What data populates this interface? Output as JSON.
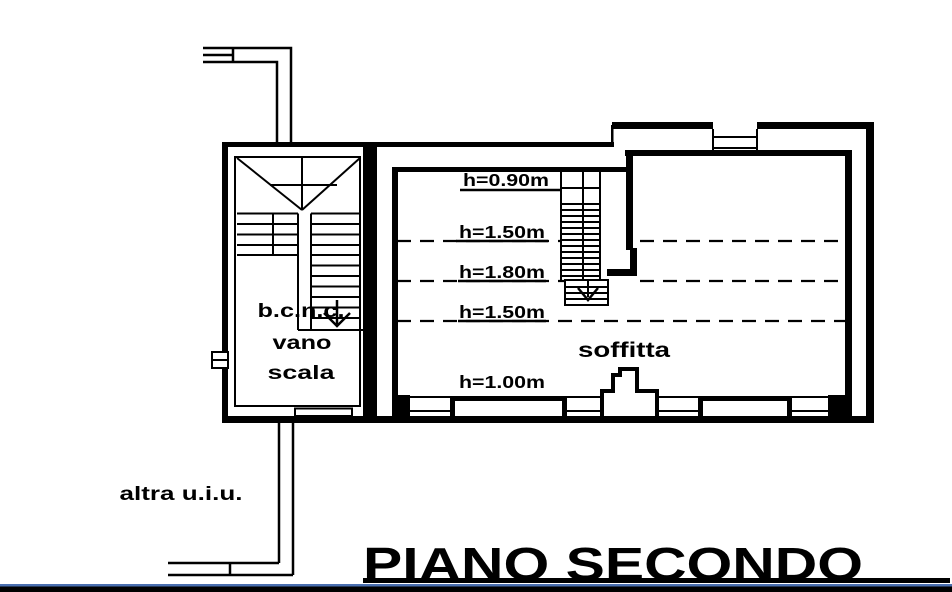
{
  "drawing": {
    "title": "PIANO SECONDO",
    "labels": {
      "other_unit": "altra u.i.u.",
      "stairwell_line1": "b.c.n.c.",
      "stairwell_line2": "vano",
      "stairwell_line3": "scala",
      "attic": "soffitta"
    },
    "height_annotations": [
      {
        "label": "h=0.90m"
      },
      {
        "label": "h=1.50m"
      },
      {
        "label": "h=1.80m"
      },
      {
        "label": "h=1.50m"
      },
      {
        "label": "h=1.00m"
      }
    ],
    "colors": {
      "line": "#000000",
      "background": "#ffffff",
      "border_accent": "#4a6fb0",
      "border_bar": "#000000"
    }
  }
}
